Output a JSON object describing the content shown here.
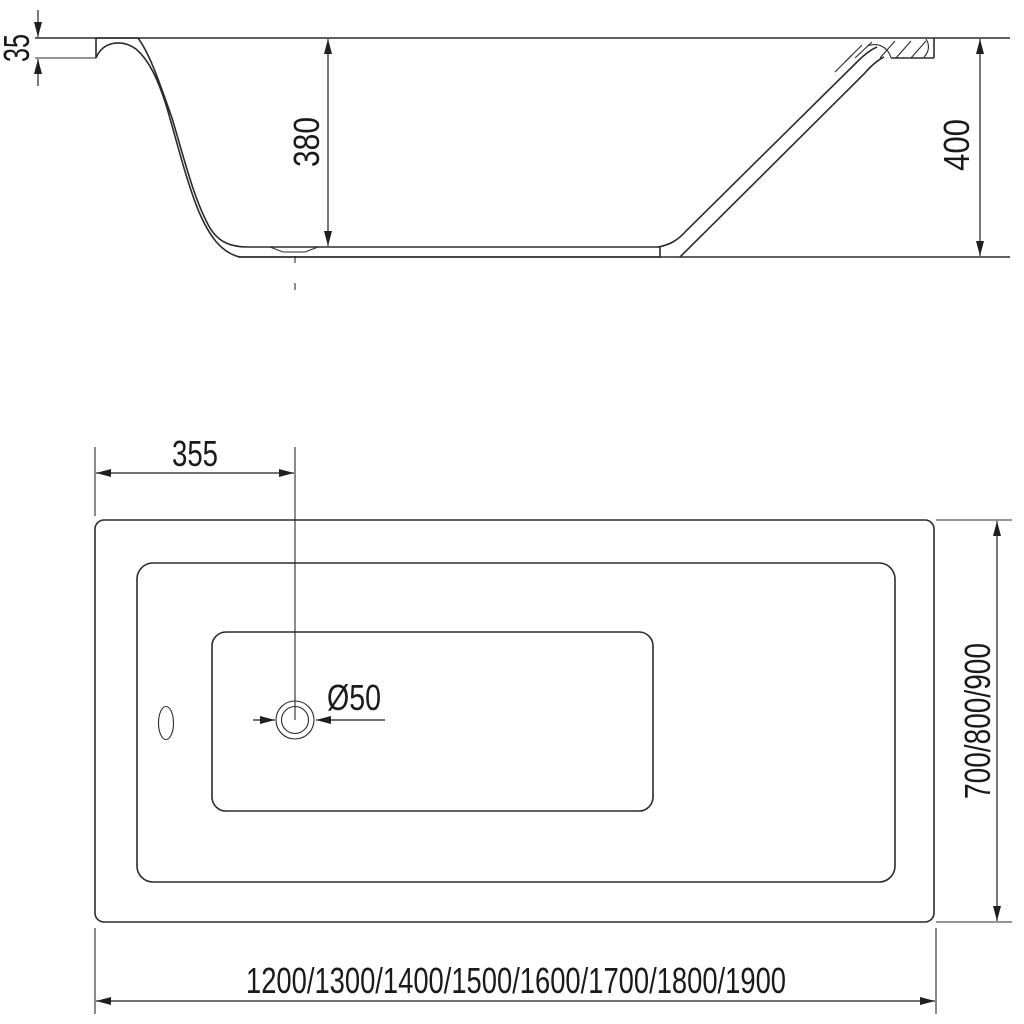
{
  "colors": {
    "background": "#ffffff",
    "line": "#2b2b2b",
    "text": "#1a1a1a"
  },
  "dimensions": {
    "rim_thickness": "35",
    "inner_depth": "380",
    "overall_height": "400",
    "drain_offset": "355",
    "drain_diameter": "Ø50",
    "width_options": "700/800/900",
    "length_options": "1200/1300/1400/1500/1600/1700/1800/1900"
  }
}
